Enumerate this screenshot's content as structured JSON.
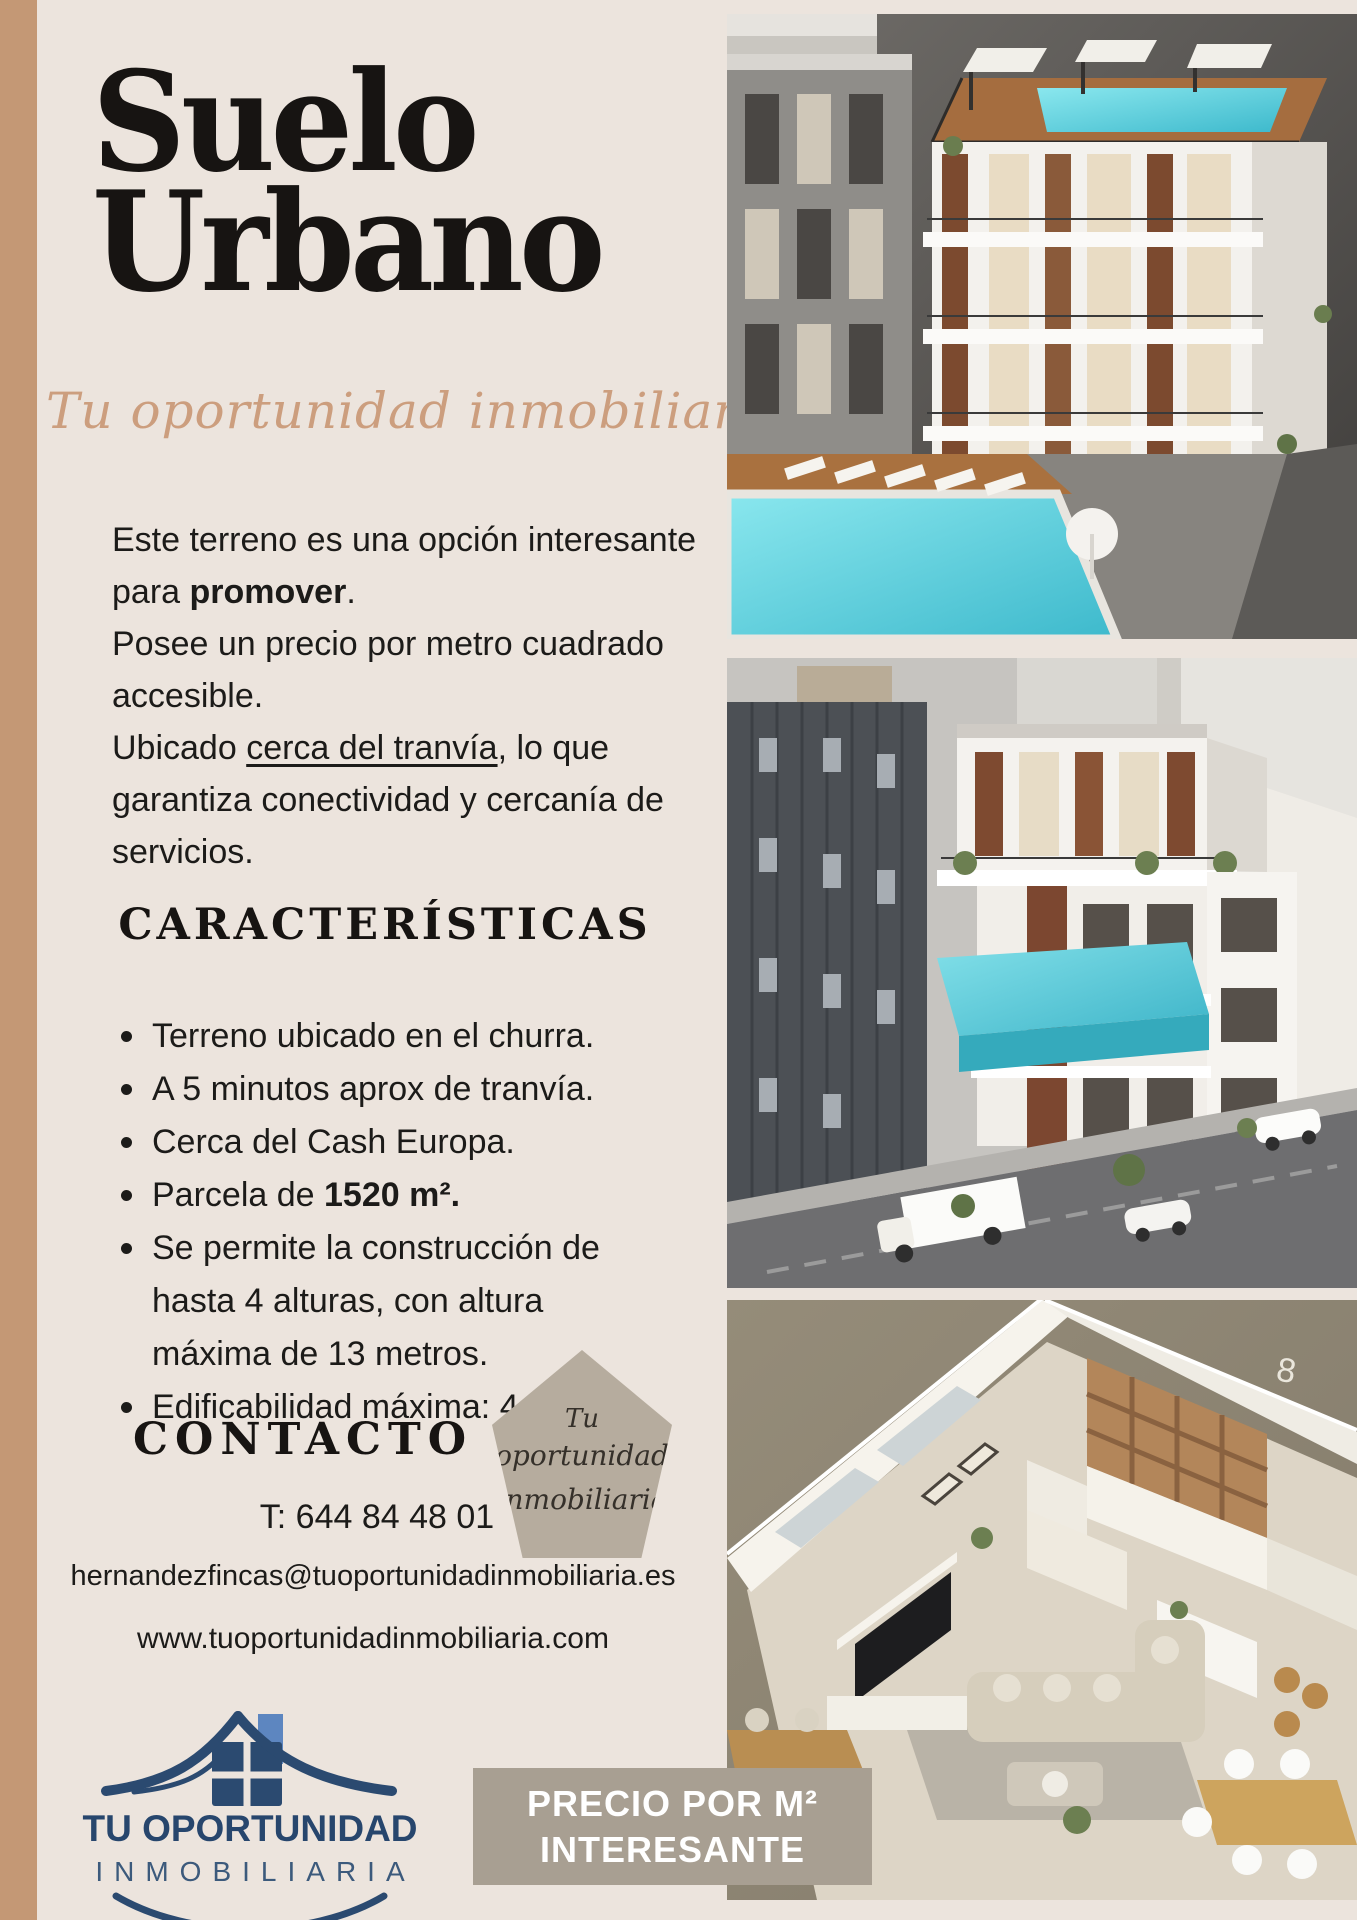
{
  "page": {
    "bg": "#ece4dd",
    "stripe_color": "#c49875",
    "text_color": "#1c1b19"
  },
  "header": {
    "title_line1": "Suelo",
    "title_line2": "Urbano",
    "tagline": "Tu oportunidad inmobiliaria",
    "tagline_color": "#cc9e7e"
  },
  "intro": {
    "p1_pre": "Este terreno es una opción interesante para ",
    "p1_bold": "promover",
    "p1_post": ".",
    "p2": "Posee un precio por metro cuadrado accesible.",
    "p3_pre": "Ubicado ",
    "p3_underline": "cerca del tranvía",
    "p3_post": ", lo que garantiza conectividad y cercanía de servicios."
  },
  "features": {
    "heading": "CARACTERÍSTICAS",
    "items": [
      {
        "text": "Terreno ubicado en el churra."
      },
      {
        "text": "A 5 minutos aprox de tranvía."
      },
      {
        "text": "Cerca del Cash Europa."
      },
      {
        "pre": "Parcela de ",
        "bold": "1520 m²."
      },
      {
        "text": "Se permite la construcción de hasta 4 alturas, con altura máxima de 13 metros."
      },
      {
        "text": "Edificabilidad máxima: 4.595m²"
      }
    ]
  },
  "contact": {
    "heading": "CONTACTO",
    "phone": "T: 644 84 48 01",
    "email": "hernandezfincas@tuoportunidadinmobiliaria.es",
    "website": "www.tuoportunidadinmobiliaria.com"
  },
  "badge": {
    "line1": "Tu",
    "line2": "oportunidad",
    "line3": "inmobiliaria",
    "bg": "#b6ac9e"
  },
  "logo": {
    "name_line1": "TU OPORTUNIDAD",
    "name_line2": "INMOBILIARIA",
    "navy": "#27466d",
    "light_blue": "#5d86c0"
  },
  "banner": {
    "line1": "PRECIO POR M²",
    "line2": "INTERESANTE",
    "bg": "#a89f92",
    "text_color": "#ffffff"
  },
  "photos": {
    "top": {
      "label": "Render 3D de edificio moderno con piscina en la azotea y piscina exterior"
    },
    "middle": {
      "label": "Render 3D de edificio blanco con piscina elevada junto a edificio gris"
    },
    "bottom": {
      "label": "Vista isométrica del interior de una vivienda",
      "wall_number": "8"
    }
  }
}
